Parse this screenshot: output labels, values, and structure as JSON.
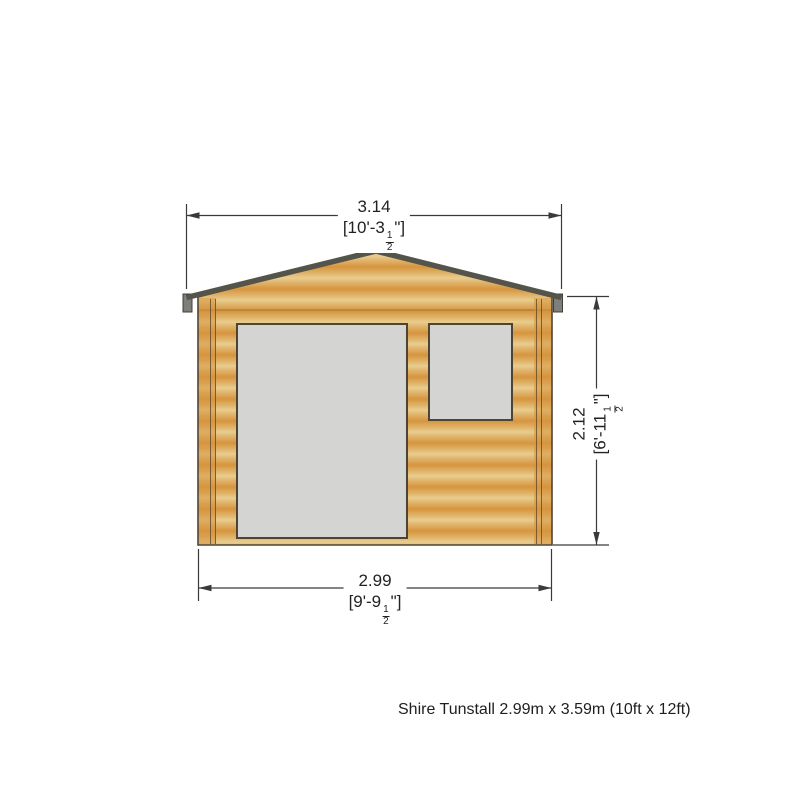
{
  "colors": {
    "background": "#ffffff",
    "wood_light": "#e9cd8f",
    "wood_mid": "#e0b269",
    "wood_dark": "#d6953f",
    "corner_board": "rgba(214,149,63,0.55)",
    "trim_line": "rgba(92,68,35,0.75)",
    "joint_line": "rgba(92,68,35,0.45)",
    "outline": "#4d4433",
    "roof_edge": "#55544b",
    "eave_cap_fill": "#7e7e7b",
    "eave_cap_stroke": "#3f3f38",
    "glass": "#d4d4d2",
    "dim": "#3a3a3a",
    "text": "#222222"
  },
  "dimensions": {
    "top_width": {
      "metric": "3.14",
      "imperial_prefix": "[10'-3",
      "frac_num": "1",
      "frac_den": "2",
      "imperial_suffix": "\"]"
    },
    "bottom_width": {
      "metric": "2.99",
      "imperial_prefix": "[9'-9",
      "frac_num": "1",
      "frac_den": "2",
      "imperial_suffix": "\"]"
    },
    "right_height": {
      "metric": "2.12",
      "imperial_prefix": "[6'-11",
      "frac_num": "1",
      "frac_den": "2",
      "imperial_suffix": "\"]"
    }
  },
  "caption": "Shire Tunstall 2.99m x 3.59m (10ft x 12ft)"
}
